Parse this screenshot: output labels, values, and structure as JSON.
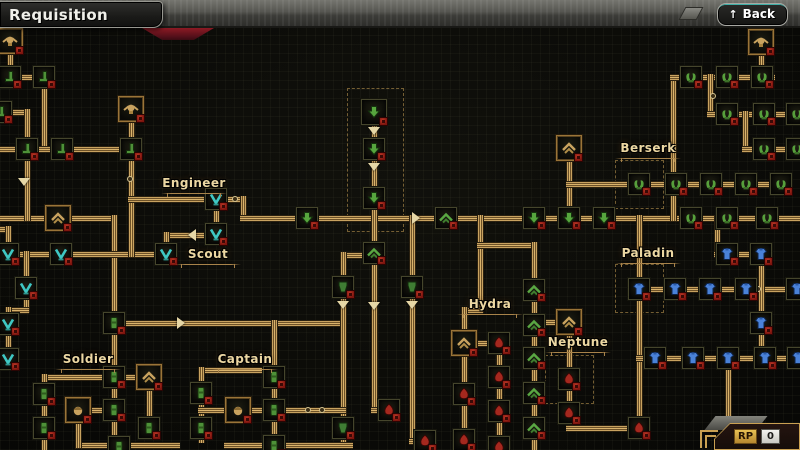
{
  "header": {
    "title": "Requisition",
    "back_label": "Back",
    "back_icon": "up-arrow"
  },
  "footer": {
    "rp_label": "RP",
    "rp_value": "0"
  },
  "colors": {
    "path_gold": "#c8a260",
    "node_green": "#57a63e",
    "node_teal": "#3fc8c4",
    "node_blue": "#4a82d8",
    "node_red": "#a5281e",
    "emblem_gold": "#c9a35f",
    "badge_red": "#8a1f18",
    "label_cream": "#ecd7a2"
  },
  "tree": {
    "labels": [
      {
        "text": "Engineer",
        "x": 194,
        "y": 176
      },
      {
        "text": "Scout",
        "x": 208,
        "y": 247
      },
      {
        "text": "Berserk",
        "x": 648,
        "y": 141
      },
      {
        "text": "Paladin",
        "x": 648,
        "y": 246
      },
      {
        "text": "Hydra",
        "x": 490,
        "y": 297
      },
      {
        "text": "Neptune",
        "x": 578,
        "y": 335
      },
      {
        "text": "Soldier",
        "x": 88,
        "y": 352
      },
      {
        "text": "Captain",
        "x": 245,
        "y": 352
      }
    ],
    "nodes": [
      [
        10,
        41,
        "skull"
      ],
      [
        131,
        109,
        "skull"
      ],
      [
        761,
        42,
        "skull"
      ],
      [
        58,
        218,
        "eagle"
      ],
      [
        569,
        148,
        "eagle"
      ],
      [
        569,
        322,
        "eagle"
      ],
      [
        464,
        343,
        "eagle"
      ],
      [
        149,
        377,
        "eagle"
      ],
      [
        78,
        410,
        "head"
      ],
      [
        238,
        410,
        "head"
      ],
      [
        10,
        77,
        "hook"
      ],
      [
        44,
        77,
        "hook"
      ],
      [
        1,
        112,
        "hook"
      ],
      [
        27,
        149,
        "hook"
      ],
      [
        62,
        149,
        "hook"
      ],
      [
        131,
        149,
        "hook"
      ],
      [
        216,
        199,
        "vee"
      ],
      [
        216,
        234,
        "vee"
      ],
      [
        166,
        254,
        "vee"
      ],
      [
        8,
        254,
        "vee"
      ],
      [
        61,
        254,
        "vee"
      ],
      [
        26,
        288,
        "vee"
      ],
      [
        8,
        324,
        "vee"
      ],
      [
        8,
        359,
        "vee"
      ],
      [
        307,
        218,
        "down"
      ],
      [
        374,
        112,
        "down",
        "big"
      ],
      [
        374,
        149,
        "down"
      ],
      [
        374,
        198,
        "down"
      ],
      [
        534,
        218,
        "down"
      ],
      [
        569,
        218,
        "down"
      ],
      [
        604,
        218,
        "down"
      ],
      [
        446,
        218,
        "wing"
      ],
      [
        374,
        253,
        "wing"
      ],
      [
        534,
        290,
        "wing"
      ],
      [
        534,
        325,
        "wing"
      ],
      [
        534,
        358,
        "wing"
      ],
      [
        534,
        393,
        "wing"
      ],
      [
        534,
        428,
        "wing"
      ],
      [
        691,
        218,
        "claws"
      ],
      [
        727,
        218,
        "claws"
      ],
      [
        767,
        218,
        "claws"
      ],
      [
        639,
        184,
        "claws"
      ],
      [
        676,
        184,
        "claws"
      ],
      [
        711,
        184,
        "claws"
      ],
      [
        746,
        184,
        "claws"
      ],
      [
        781,
        184,
        "claws"
      ],
      [
        691,
        77,
        "claws"
      ],
      [
        727,
        77,
        "claws"
      ],
      [
        762,
        77,
        "claws"
      ],
      [
        727,
        114,
        "claws"
      ],
      [
        764,
        114,
        "claws"
      ],
      [
        797,
        114,
        "claws"
      ],
      [
        764,
        149,
        "claws"
      ],
      [
        797,
        149,
        "claws"
      ],
      [
        727,
        254,
        "armorB"
      ],
      [
        761,
        254,
        "armorB"
      ],
      [
        639,
        289,
        "armorB"
      ],
      [
        675,
        289,
        "armorB"
      ],
      [
        710,
        289,
        "armorB"
      ],
      [
        746,
        289,
        "armorB"
      ],
      [
        797,
        289,
        "armorB"
      ],
      [
        761,
        323,
        "armorB"
      ],
      [
        655,
        358,
        "armorB"
      ],
      [
        693,
        358,
        "armorB"
      ],
      [
        728,
        358,
        "armorB"
      ],
      [
        765,
        358,
        "armorB"
      ],
      [
        798,
        358,
        "armorB"
      ],
      [
        343,
        287,
        "armorG"
      ],
      [
        412,
        287,
        "armorG"
      ],
      [
        343,
        428,
        "armorG"
      ],
      [
        114,
        323,
        "pack"
      ],
      [
        114,
        377,
        "pack"
      ],
      [
        44,
        394,
        "pack"
      ],
      [
        114,
        410,
        "pack"
      ],
      [
        44,
        428,
        "pack"
      ],
      [
        149,
        428,
        "pack"
      ],
      [
        119,
        447,
        "pack"
      ],
      [
        274,
        377,
        "pack"
      ],
      [
        201,
        393,
        "pack"
      ],
      [
        274,
        410,
        "pack"
      ],
      [
        201,
        428,
        "pack"
      ],
      [
        274,
        446,
        "pack"
      ],
      [
        499,
        343,
        "flame"
      ],
      [
        499,
        377,
        "flame"
      ],
      [
        499,
        411,
        "flame"
      ],
      [
        464,
        394,
        "flame"
      ],
      [
        569,
        379,
        "flame"
      ],
      [
        569,
        413,
        "flame"
      ],
      [
        639,
        428,
        "flame"
      ],
      [
        389,
        410,
        "flame"
      ],
      [
        425,
        441,
        "flame"
      ],
      [
        499,
        447,
        "flame"
      ],
      [
        464,
        440,
        "flame"
      ]
    ],
    "edges": [
      [
        [
          0,
          218
        ],
        [
          114,
          218
        ],
        [
          114,
          447
        ]
      ],
      [
        [
          114,
          323
        ],
        [
          343,
          323
        ]
      ],
      [
        [
          374,
          255
        ],
        [
          343,
          255
        ],
        [
          343,
          445
        ]
      ],
      [
        [
          78,
          445
        ],
        [
          177,
          445
        ]
      ],
      [
        [
          227,
          445
        ],
        [
          350,
          445
        ]
      ],
      [
        [
          114,
          377
        ],
        [
          149,
          377
        ]
      ],
      [
        [
          114,
          377
        ],
        [
          44,
          377
        ],
        [
          44,
          450
        ]
      ],
      [
        [
          78,
          445
        ],
        [
          78,
          410
        ],
        [
          114,
          410
        ]
      ],
      [
        [
          149,
          386
        ],
        [
          149,
          428
        ]
      ],
      [
        [
          274,
          323
        ],
        [
          274,
          446
        ]
      ],
      [
        [
          274,
          370
        ],
        [
          201,
          370
        ],
        [
          201,
          440
        ]
      ],
      [
        [
          201,
          410
        ],
        [
          274,
          410
        ]
      ],
      [
        [
          274,
          410
        ],
        [
          343,
          410
        ]
      ],
      [
        [
          0,
          229
        ],
        [
          8,
          229
        ],
        [
          8,
          254
        ]
      ],
      [
        [
          8,
          254
        ],
        [
          166,
          254
        ]
      ],
      [
        [
          26,
          254
        ],
        [
          26,
          310
        ],
        [
          8,
          310
        ],
        [
          8,
          359
        ]
      ],
      [
        [
          216,
          208
        ],
        [
          216,
          234
        ]
      ],
      [
        [
          216,
          235
        ],
        [
          166,
          235
        ],
        [
          166,
          254
        ]
      ],
      [
        [
          131,
          158
        ],
        [
          131,
          254
        ]
      ],
      [
        [
          131,
          199
        ],
        [
          216,
          199
        ]
      ],
      [
        [
          228,
          199
        ],
        [
          243,
          199
        ],
        [
          243,
          218
        ]
      ],
      [
        [
          243,
          218
        ],
        [
          800,
          218
        ]
      ],
      [
        [
          10,
          41
        ],
        [
          10,
          77
        ]
      ],
      [
        [
          10,
          77
        ],
        [
          44,
          77
        ]
      ],
      [
        [
          44,
          87
        ],
        [
          44,
          149
        ]
      ],
      [
        [
          0,
          149
        ],
        [
          131,
          149
        ]
      ],
      [
        [
          1,
          112
        ],
        [
          27,
          112
        ],
        [
          27,
          218
        ]
      ],
      [
        [
          131,
          109
        ],
        [
          131,
          149
        ]
      ],
      [
        [
          374,
          103
        ],
        [
          374,
          218
        ]
      ],
      [
        [
          374,
          218
        ],
        [
          374,
          410
        ],
        [
          389,
          410
        ]
      ],
      [
        [
          412,
          218
        ],
        [
          412,
          441
        ],
        [
          425,
          441
        ]
      ],
      [
        [
          480,
          218
        ],
        [
          480,
          310
        ],
        [
          464,
          310
        ],
        [
          464,
          450
        ]
      ],
      [
        [
          480,
          245
        ],
        [
          534,
          245
        ],
        [
          534,
          450
        ]
      ],
      [
        [
          464,
          343
        ],
        [
          499,
          343
        ]
      ],
      [
        [
          499,
          343
        ],
        [
          499,
          450
        ]
      ],
      [
        [
          534,
          322
        ],
        [
          569,
          322
        ]
      ],
      [
        [
          569,
          333
        ],
        [
          569,
          428
        ],
        [
          639,
          428
        ]
      ],
      [
        [
          569,
          159
        ],
        [
          569,
          207
        ]
      ],
      [
        [
          569,
          184
        ],
        [
          790,
          184
        ]
      ],
      [
        [
          673,
          77
        ],
        [
          673,
          218
        ]
      ],
      [
        [
          673,
          77
        ],
        [
          772,
          77
        ]
      ],
      [
        [
          761,
          53
        ],
        [
          761,
          66
        ]
      ],
      [
        [
          710,
          77
        ],
        [
          710,
          114
        ]
      ],
      [
        [
          710,
          114
        ],
        [
          800,
          114
        ]
      ],
      [
        [
          745,
          114
        ],
        [
          745,
          149
        ]
      ],
      [
        [
          745,
          149
        ],
        [
          800,
          149
        ]
      ],
      [
        [
          639,
          218
        ],
        [
          639,
          428
        ]
      ],
      [
        [
          639,
          289
        ],
        [
          800,
          289
        ]
      ],
      [
        [
          717,
          218
        ],
        [
          717,
          254
        ],
        [
          761,
          254
        ]
      ],
      [
        [
          761,
          263
        ],
        [
          761,
          323
        ]
      ],
      [
        [
          761,
          323
        ],
        [
          761,
          358
        ]
      ],
      [
        [
          639,
          358
        ],
        [
          800,
          358
        ]
      ],
      [
        [
          728,
          369
        ],
        [
          728,
          450
        ]
      ]
    ],
    "chevrons": [
      {
        "x": 374,
        "y": 131,
        "dir": "d"
      },
      {
        "x": 374,
        "y": 167,
        "dir": "d"
      },
      {
        "x": 24,
        "y": 182,
        "dir": "d"
      },
      {
        "x": 190,
        "y": 235,
        "dir": "l"
      },
      {
        "x": 183,
        "y": 323,
        "dir": "r"
      },
      {
        "x": 343,
        "y": 305,
        "dir": "d"
      },
      {
        "x": 374,
        "y": 306,
        "dir": "d"
      },
      {
        "x": 412,
        "y": 305,
        "dir": "d"
      },
      {
        "x": 418,
        "y": 218,
        "dir": "r"
      }
    ],
    "rings": [
      {
        "x": 130,
        "y": 179
      },
      {
        "x": 235,
        "y": 199
      },
      {
        "x": 308,
        "y": 410
      },
      {
        "x": 322,
        "y": 410
      },
      {
        "x": 758,
        "y": 289
      },
      {
        "x": 713,
        "y": 96
      },
      {
        "x": 673,
        "y": 150
      }
    ],
    "brackets": [
      {
        "x": 347,
        "y": 88,
        "w": 55,
        "h": 142
      },
      {
        "x": 615,
        "y": 160,
        "w": 47,
        "h": 47
      },
      {
        "x": 615,
        "y": 264,
        "w": 47,
        "h": 47
      },
      {
        "x": 545,
        "y": 355,
        "w": 47,
        "h": 47
      }
    ]
  }
}
